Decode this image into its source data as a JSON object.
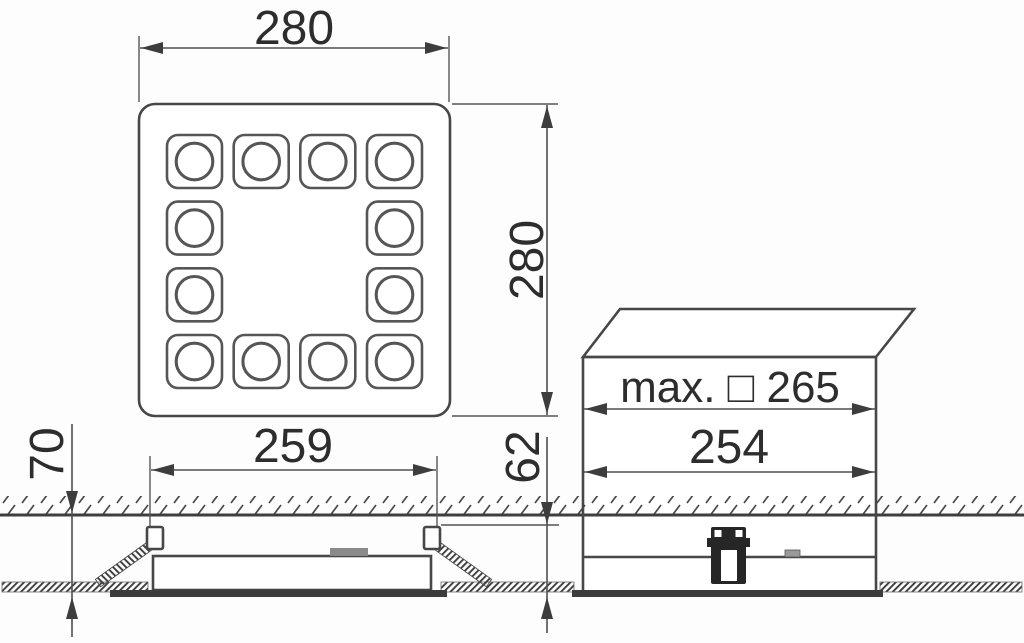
{
  "drawing": {
    "top_view": {
      "width": "280",
      "height": "280"
    },
    "installation_section": {
      "ceiling_cutout": "259",
      "min_recess_depth": "70",
      "recessed_height": "62"
    },
    "housing_view": {
      "max_cutout": "max. □ 265",
      "housing_width": "254"
    }
  }
}
